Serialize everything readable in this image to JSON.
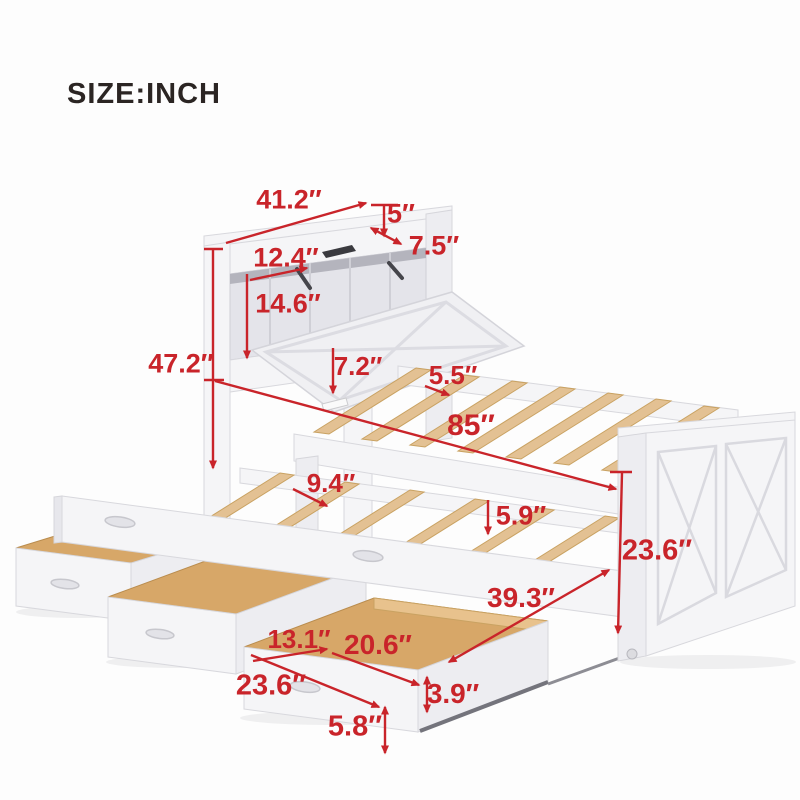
{
  "title": {
    "size_label": "SIZE:INCH"
  },
  "colors": {
    "dimension_red": "#c9242a",
    "text_dark": "#2b2523",
    "background": "#fdfdfd",
    "frame_white": "#f5f5f7",
    "frame_stroke": "#d8d8dd",
    "wood_slat": "#e3c193",
    "wood_drawer": "#d7a768"
  },
  "diagram": {
    "dimensions": [
      {
        "id": "headboard-width",
        "label": "41.2″",
        "lx": 289,
        "ly": 200,
        "size": 27,
        "line": [
          226,
          243,
          366,
          203
        ],
        "arrows": "end"
      },
      {
        "id": "top-shelf-height",
        "label": "5″",
        "lx": 401,
        "ly": 214,
        "size": 27,
        "line": [
          384,
          206,
          384,
          236
        ],
        "arrows": "end",
        "tick": [
          371,
          205,
          398,
          205
        ]
      },
      {
        "id": "top-shelf-depth",
        "label": "7.5″",
        "lx": 434,
        "ly": 246,
        "size": 27,
        "line": [
          371,
          228,
          401,
          244
        ],
        "arrows": "both"
      },
      {
        "id": "compartment-depth",
        "label": "12.4″",
        "lx": 286,
        "ly": 258,
        "size": 27,
        "line": [
          250,
          280,
          307,
          268
        ],
        "arrows": "end"
      },
      {
        "id": "compartment-height",
        "label": "14.6″",
        "lx": 288,
        "ly": 304,
        "size": 27,
        "line": [
          247,
          274,
          247,
          358
        ],
        "arrows": "end"
      },
      {
        "id": "headboard-height",
        "label": "47.2″",
        "lx": 181,
        "ly": 364,
        "size": 27,
        "line": [
          213,
          249,
          213,
          468
        ],
        "arrows": "end",
        "tick": [
          204,
          249,
          223,
          249
        ]
      },
      {
        "id": "frame-rail-height",
        "label": "7.2″",
        "lx": 358,
        "ly": 366,
        "size": 26,
        "line": [
          333,
          348,
          333,
          393
        ],
        "arrows": "end"
      },
      {
        "id": "slat-spacing",
        "label": "5.5″",
        "lx": 453,
        "ly": 375,
        "size": 26,
        "line": [
          425,
          386,
          449,
          395
        ],
        "arrows": "end"
      },
      {
        "id": "bed-length",
        "label": "85″",
        "lx": 471,
        "ly": 426,
        "size": 30,
        "line": [
          215,
          381,
          616,
          489
        ],
        "arrows": "end",
        "tick": [
          204,
          380,
          224,
          380
        ]
      },
      {
        "id": "trundle-slat-spacing",
        "label": "9.4″",
        "lx": 331,
        "ly": 483,
        "size": 26,
        "line": [
          293,
          489,
          327,
          506
        ],
        "arrows": "end"
      },
      {
        "id": "trundle-rail-height",
        "label": "5.9″",
        "lx": 521,
        "ly": 516,
        "size": 27,
        "line": [
          488,
          500,
          488,
          534
        ],
        "arrows": "end"
      },
      {
        "id": "footboard-height",
        "label": "23.6″",
        "lx": 657,
        "ly": 551,
        "size": 29,
        "line": [
          622,
          473,
          618,
          633
        ],
        "arrows": "end",
        "tick": [
          610,
          472,
          632,
          472
        ]
      },
      {
        "id": "trundle-length",
        "label": "39.3″",
        "lx": 521,
        "ly": 598,
        "size": 28,
        "line": [
          609,
          570,
          449,
          662
        ],
        "arrows": "both"
      },
      {
        "id": "drawer-width",
        "label": "13.1″",
        "lx": 299,
        "ly": 639,
        "size": 26,
        "line": [
          253,
          661,
          327,
          649
        ],
        "arrows": "end"
      },
      {
        "id": "drawer-length",
        "label": "20.6″",
        "lx": 378,
        "ly": 645,
        "size": 28,
        "line": [
          332,
          653,
          419,
          685
        ],
        "arrows": "end"
      },
      {
        "id": "drawer-depth",
        "label": "23.6″",
        "lx": 271,
        "ly": 686,
        "size": 29,
        "line": [
          251,
          655,
          379,
          707
        ],
        "arrows": "end"
      },
      {
        "id": "drawer-front-height",
        "label": "3.9″",
        "lx": 453,
        "ly": 694,
        "size": 28,
        "line": [
          427,
          677,
          427,
          712
        ],
        "arrows": "both"
      },
      {
        "id": "drawer-total-height",
        "label": "5.8″",
        "lx": 355,
        "ly": 727,
        "size": 29,
        "line": [
          385,
          707,
          385,
          753
        ],
        "arrows": "both"
      }
    ]
  }
}
